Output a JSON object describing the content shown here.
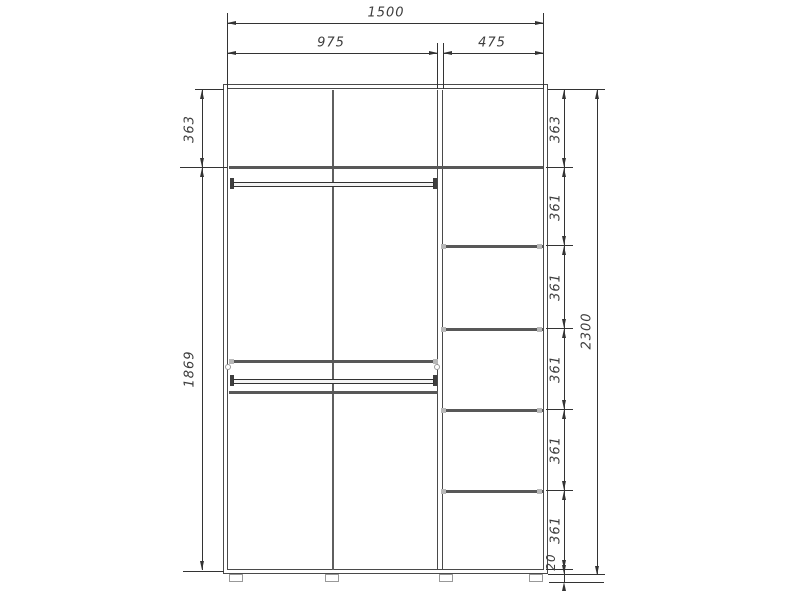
{
  "drawing": {
    "type": "wardrobe-dimension-drawing",
    "top_dims": {
      "overall_width": "1500",
      "left_section_width": "975",
      "right_section_width": "475"
    },
    "left_dims": {
      "top_compartment": "363",
      "main_compartment": "1869"
    },
    "right_dims": {
      "segments": [
        "363",
        "361",
        "361",
        "361",
        "361",
        "361"
      ],
      "base_gap": "20",
      "overall_height": "2300"
    }
  }
}
